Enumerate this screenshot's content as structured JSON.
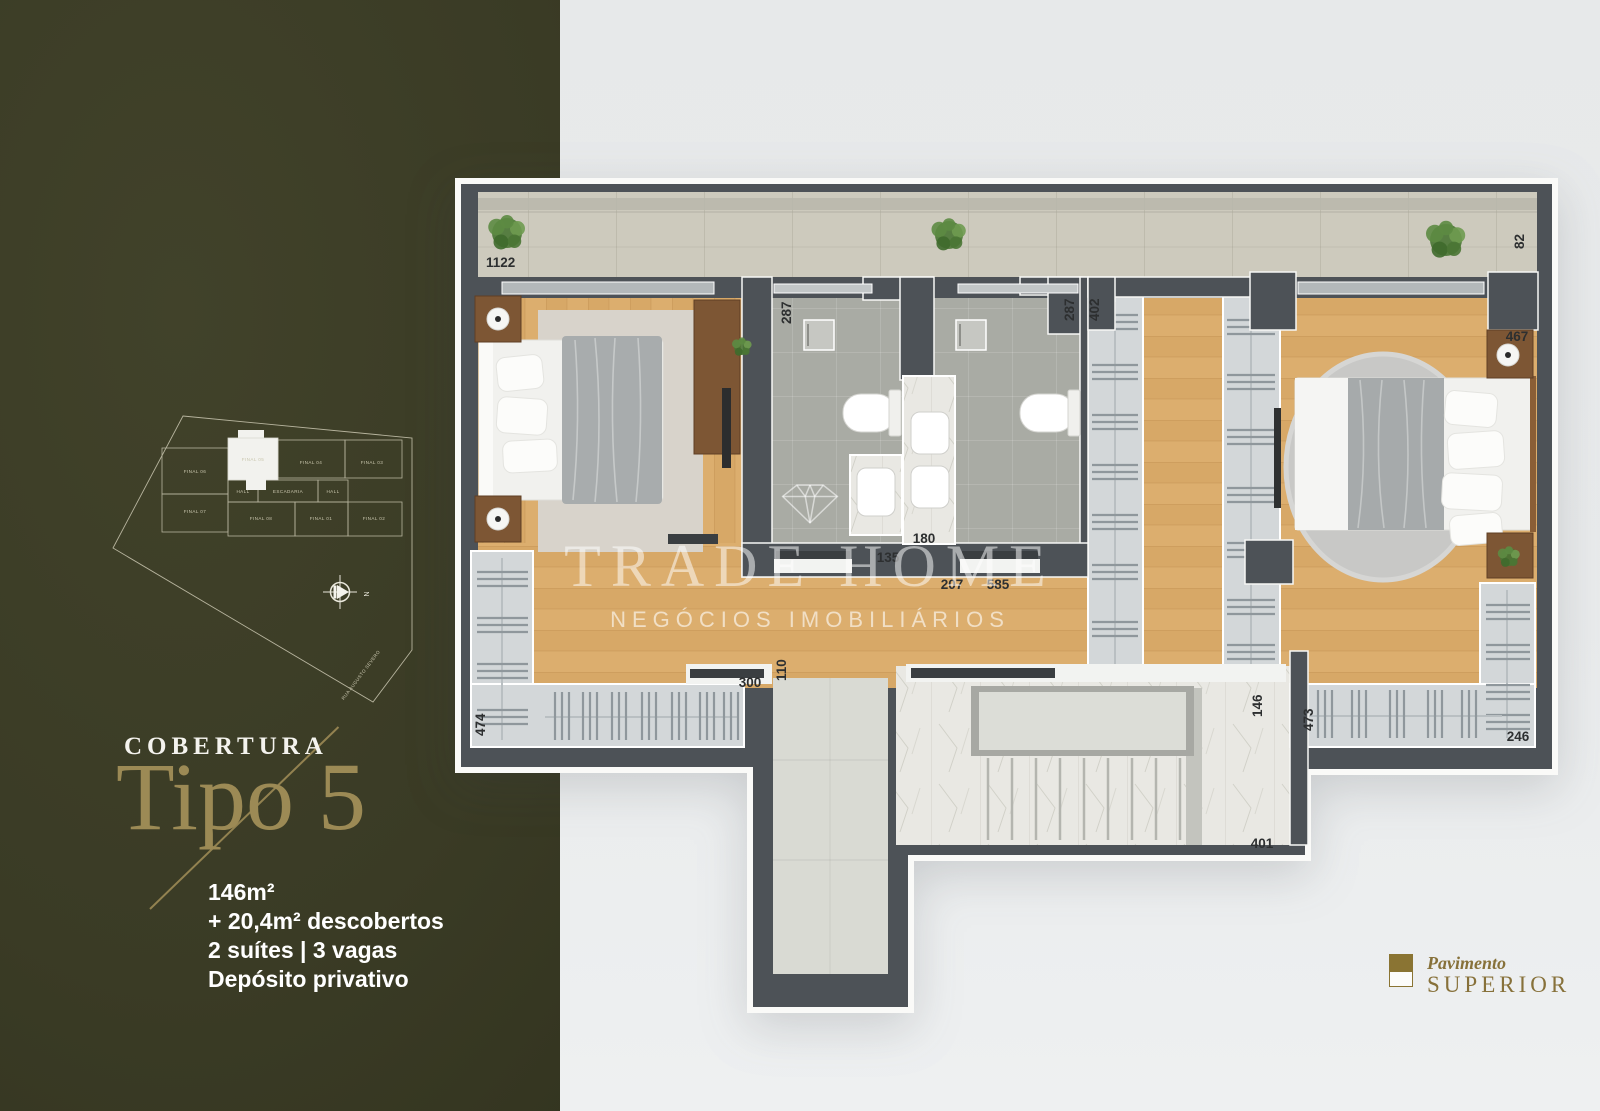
{
  "left_panel": {
    "background_color": "#3a3b25",
    "accent_color": "#9c8a55",
    "category_label": "COBERTURA",
    "title": "Tipo 5",
    "details": [
      "146m²",
      "+ 20,4m² descobertos",
      "2 suítes | 3 vagas",
      "Depósito privativo"
    ],
    "keyplan": {
      "highlighted_unit": "FINAL 05",
      "units": [
        "FINAL 06",
        "FINAL 05",
        "FINAL 04",
        "FINAL 03",
        "HALL",
        "ESCADARIA",
        "HALL",
        "FINAL 07",
        "FINAL 08",
        "FINAL 01",
        "FINAL 02"
      ],
      "street_label": "RUA AUGUSTO SEVERO",
      "compass_label": "N"
    }
  },
  "watermark": {
    "brand": "TRADE HOME",
    "tagline": "NEGÓCIOS IMOBILIÁRIOS",
    "icon": "diamond-icon"
  },
  "floor_plan": {
    "wall_color": "#4d5257",
    "wood_color": "#dcae6e",
    "measurements": [
      "1122",
      "82",
      "287",
      "287",
      "402",
      "467",
      "135",
      "180",
      "207",
      "585",
      "300",
      "110",
      "474",
      "473",
      "146",
      "246",
      "401"
    ]
  },
  "footer": {
    "small_label": "Pavimento",
    "big_label": "SUPERIOR"
  }
}
